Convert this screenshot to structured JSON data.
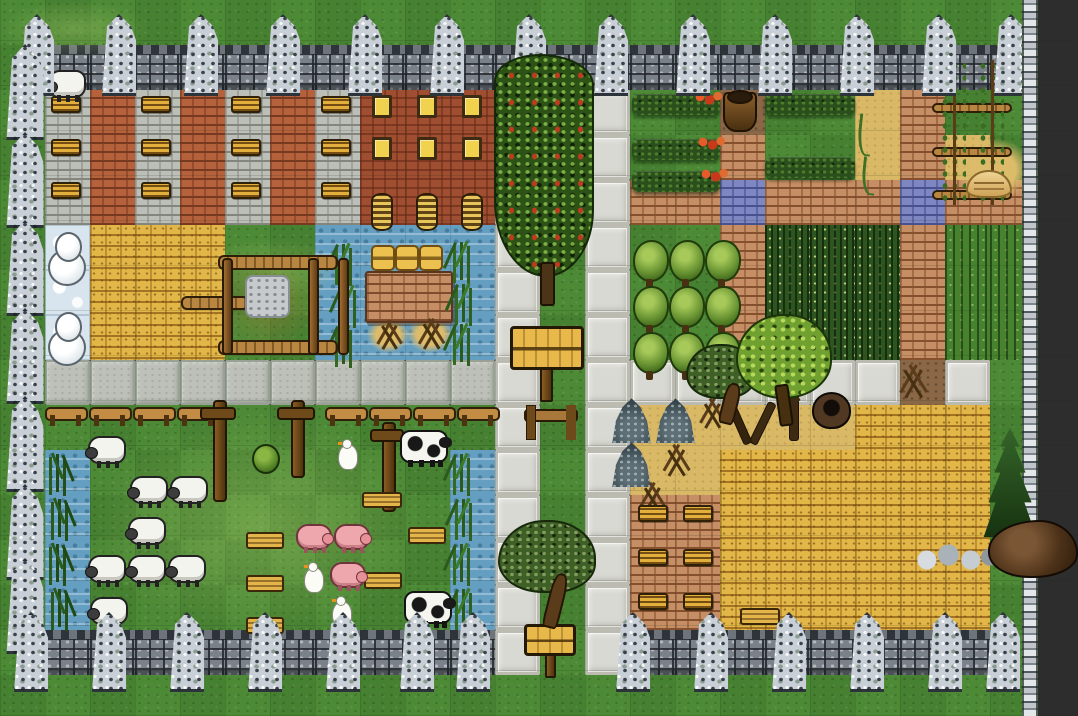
{
  "scene": {
    "description": "top-down tile map of a walled medieval farm village with buildings, orchards, crop fields, pastures with livestock, stone paths and a large hay field",
    "width_px": 1078,
    "height_px": 716,
    "outside_color": "#2d2d2d"
  },
  "palette": {
    "grass": "#4d8a36",
    "path_white": "#d9d9d3",
    "road_gray": "#bcc0b8",
    "water": "#649fc2",
    "ice": "#d8e5ee",
    "hay": "#e3b648",
    "sand": "#d9b866",
    "dirt": "#8a6847",
    "brick_wall": "#c68e64",
    "water_gate_brick": "#7e87c2",
    "gray_building": "#bcbeb8",
    "red_building_stripe": "#b5613c",
    "red_building": "#a04e31",
    "wheat_crop": "#2d5520",
    "spiky_crop": "#47822f",
    "stone_wall": "#7b8189",
    "tower_stone": "#c9cfd6"
  },
  "map": {
    "tile_px": 45,
    "cols": 24,
    "rows_count": 16,
    "legend": {
      "G": "grass",
      "D": "outside",
      "M": "stone-wall",
      "P": "white-path",
      "Q": "gray-road",
      "W": "water",
      "I": "ice",
      "H": "hay",
      "S": "sand",
      "T": "dirt",
      "B": "brick-wall",
      "U": "water-gate",
      "X": "gray-brick-building",
      "R": "red-brick-building",
      "V": "red-building",
      "E": "wheat-crop",
      "F": "spiky-crop"
    },
    "rows": [
      "GGGGGGGGGGGGGGGGGGGGGGGD",
      "GMMMMMMMMMMMMMMMMMMMMMMD",
      "GXRXRXRXVVVPGPGGTGGSBGGD",
      "GXRXRXRXVVVPGPGGBGGSBSGD",
      "GXRXRXRXVVVPGPBBUBBBUBBD",
      "GIHHHGGWWWWPGPGGBEEEBFFD",
      "GIHHHGGWWWWPGPGGBEEEBFFD",
      "GIHHHGGWWWWPGPGGBEEEBFFD",
      "GQQQQQQQQQQPGPPPPPPPTPGD",
      "GGGGGGGGGGGPGPSSSSSHHHGD",
      "GWGGGGGGGGWPGPSSHHHHHHGD",
      "GWGGGGGGGGWPGPBBHHHHHHGD",
      "GWGGGGGGGGWPGPBBHHHHHHGD",
      "GWGGGGGGGGWPGPBBHHHHHHGD",
      "GMMMMMMMMMMPGPMMMMMMMMGD",
      "GGGGGGGGGGGGGGGGGGGGGGGD"
    ]
  },
  "overlays": [
    {
      "t": "lightgrass",
      "x": 0,
      "y": 0,
      "w": 150,
      "h": 58
    },
    {
      "t": "lightgrass",
      "x": 95,
      "y": 412,
      "w": 330,
      "h": 225
    },
    {
      "t": "lightgrass",
      "x": 200,
      "y": 238,
      "w": 145,
      "h": 62
    },
    {
      "t": "drypatch",
      "x": 208,
      "y": 250,
      "w": 120,
      "h": 108
    },
    {
      "t": "sandpatch",
      "x": 367,
      "y": 317,
      "w": 42,
      "h": 36
    },
    {
      "t": "sandpatch",
      "x": 407,
      "y": 316,
      "w": 46,
      "h": 37
    },
    {
      "t": "sandpatch",
      "x": 956,
      "y": 138,
      "w": 76,
      "h": 64
    },
    {
      "t": "window-log",
      "x": 51,
      "y": 96,
      "w": 30,
      "h": 17
    },
    {
      "t": "window-log",
      "x": 141,
      "y": 96,
      "w": 30,
      "h": 17
    },
    {
      "t": "window-log",
      "x": 231,
      "y": 96,
      "w": 30,
      "h": 17
    },
    {
      "t": "window-log",
      "x": 321,
      "y": 96,
      "w": 30,
      "h": 17
    },
    {
      "t": "window-log",
      "x": 51,
      "y": 139,
      "w": 30,
      "h": 17
    },
    {
      "t": "window-log",
      "x": 141,
      "y": 139,
      "w": 30,
      "h": 17
    },
    {
      "t": "window-log",
      "x": 231,
      "y": 139,
      "w": 30,
      "h": 17
    },
    {
      "t": "window-log",
      "x": 321,
      "y": 139,
      "w": 30,
      "h": 17
    },
    {
      "t": "window-log",
      "x": 51,
      "y": 182,
      "w": 30,
      "h": 17
    },
    {
      "t": "window-log",
      "x": 141,
      "y": 182,
      "w": 30,
      "h": 17
    },
    {
      "t": "window-log",
      "x": 231,
      "y": 182,
      "w": 30,
      "h": 17
    },
    {
      "t": "window-log",
      "x": 321,
      "y": 182,
      "w": 30,
      "h": 17
    },
    {
      "t": "window-yellow",
      "x": 372,
      "y": 95,
      "w": 20,
      "h": 23
    },
    {
      "t": "window-yellow",
      "x": 417,
      "y": 95,
      "w": 20,
      "h": 23
    },
    {
      "t": "window-yellow",
      "x": 462,
      "y": 95,
      "w": 20,
      "h": 23
    },
    {
      "t": "window-yellow",
      "x": 372,
      "y": 137,
      "w": 20,
      "h": 23
    },
    {
      "t": "window-yellow",
      "x": 417,
      "y": 137,
      "w": 20,
      "h": 23
    },
    {
      "t": "window-yellow",
      "x": 462,
      "y": 137,
      "w": 20,
      "h": 23
    },
    {
      "t": "coil",
      "x": 371,
      "y": 193,
      "w": 22,
      "h": 38
    },
    {
      "t": "coil",
      "x": 416,
      "y": 193,
      "w": 22,
      "h": 38
    },
    {
      "t": "coil",
      "x": 461,
      "y": 193,
      "w": 22,
      "h": 38
    },
    {
      "t": "hedge",
      "x": 632,
      "y": 94,
      "w": 88,
      "h": 21
    },
    {
      "t": "hedge",
      "x": 632,
      "y": 139,
      "w": 88,
      "h": 21
    },
    {
      "t": "hedge",
      "x": 632,
      "y": 171,
      "w": 88,
      "h": 21
    },
    {
      "t": "hedge",
      "x": 765,
      "y": 94,
      "w": 90,
      "h": 21
    },
    {
      "t": "hedge",
      "x": 765,
      "y": 157,
      "w": 90,
      "h": 21
    },
    {
      "t": "fruit",
      "x": 692,
      "y": 89,
      "w": 32,
      "h": 18
    },
    {
      "t": "fruit",
      "x": 695,
      "y": 134,
      "w": 32,
      "h": 18
    },
    {
      "t": "fruit",
      "x": 698,
      "y": 166,
      "w": 32,
      "h": 18
    },
    {
      "t": "sprout",
      "x": 858,
      "y": 114,
      "w": 14,
      "h": 42
    },
    {
      "t": "sprout",
      "x": 862,
      "y": 157,
      "w": 14,
      "h": 38
    },
    {
      "t": "pot",
      "x": 723,
      "y": 92,
      "w": 34,
      "h": 40
    },
    {
      "t": "fence-bar",
      "x": 932,
      "y": 103,
      "w": 80,
      "h": 10
    },
    {
      "t": "fence-bar",
      "x": 932,
      "y": 147,
      "w": 80,
      "h": 10
    },
    {
      "t": "fence-bar",
      "x": 932,
      "y": 190,
      "w": 80,
      "h": 10
    },
    {
      "t": "beanpole",
      "x": 940,
      "y": 60,
      "w": 26,
      "h": 145
    },
    {
      "t": "beanpole",
      "x": 978,
      "y": 60,
      "w": 26,
      "h": 145
    },
    {
      "t": "bread",
      "x": 966,
      "y": 170,
      "w": 46,
      "h": 28
    },
    {
      "t": "shrub",
      "x": 633,
      "y": 240,
      "w": 36,
      "h": 42
    },
    {
      "t": "shrub",
      "x": 669,
      "y": 240,
      "w": 36,
      "h": 42
    },
    {
      "t": "shrub",
      "x": 705,
      "y": 240,
      "w": 36,
      "h": 42
    },
    {
      "t": "shrub",
      "x": 633,
      "y": 286,
      "w": 36,
      "h": 42
    },
    {
      "t": "shrub",
      "x": 669,
      "y": 286,
      "w": 36,
      "h": 42
    },
    {
      "t": "shrub",
      "x": 705,
      "y": 286,
      "w": 36,
      "h": 42
    },
    {
      "t": "shrub",
      "x": 633,
      "y": 332,
      "w": 36,
      "h": 42
    },
    {
      "t": "shrub",
      "x": 669,
      "y": 332,
      "w": 36,
      "h": 42
    },
    {
      "t": "shrub",
      "x": 705,
      "y": 332,
      "w": 36,
      "h": 42
    },
    {
      "t": "brickchunk",
      "x": 365,
      "y": 271,
      "w": 88,
      "h": 52
    },
    {
      "t": "bale",
      "x": 371,
      "y": 245,
      "w": 24,
      "h": 26
    },
    {
      "t": "bale",
      "x": 395,
      "y": 245,
      "w": 24,
      "h": 26
    },
    {
      "t": "bale",
      "x": 419,
      "y": 245,
      "w": 24,
      "h": 26
    },
    {
      "t": "deadbush",
      "x": 372,
      "y": 321,
      "w": 32,
      "h": 30
    },
    {
      "t": "deadbush",
      "x": 412,
      "y": 319,
      "w": 36,
      "h": 32
    },
    {
      "t": "corn",
      "x": 330,
      "y": 242,
      "w": 26,
      "h": 40
    },
    {
      "t": "corn",
      "x": 334,
      "y": 284,
      "w": 26,
      "h": 40
    },
    {
      "t": "corn",
      "x": 330,
      "y": 324,
      "w": 26,
      "h": 40
    },
    {
      "t": "corn",
      "x": 448,
      "y": 240,
      "w": 26,
      "h": 40
    },
    {
      "t": "corn",
      "x": 450,
      "y": 282,
      "w": 26,
      "h": 40
    },
    {
      "t": "corn",
      "x": 448,
      "y": 322,
      "w": 26,
      "h": 40
    },
    {
      "t": "corn",
      "x": 448,
      "y": 452,
      "w": 26,
      "h": 40
    },
    {
      "t": "corn",
      "x": 450,
      "y": 497,
      "w": 26,
      "h": 40
    },
    {
      "t": "corn",
      "x": 448,
      "y": 542,
      "w": 26,
      "h": 40
    },
    {
      "t": "corn",
      "x": 450,
      "y": 587,
      "w": 26,
      "h": 40
    },
    {
      "t": "reed",
      "x": 44,
      "y": 452,
      "w": 26,
      "h": 40
    },
    {
      "t": "reed",
      "x": 46,
      "y": 497,
      "w": 26,
      "h": 40
    },
    {
      "t": "reed",
      "x": 44,
      "y": 542,
      "w": 26,
      "h": 40
    },
    {
      "t": "reed",
      "x": 46,
      "y": 587,
      "w": 26,
      "h": 40
    },
    {
      "t": "fence-bar",
      "x": 218,
      "y": 255,
      "w": 120,
      "h": 15
    },
    {
      "t": "fence-bar",
      "x": 218,
      "y": 340,
      "w": 120,
      "h": 15
    },
    {
      "t": "fence-bar",
      "x": 181,
      "y": 296,
      "w": 68,
      "h": 14
    },
    {
      "t": "fence-pole",
      "x": 222,
      "y": 258,
      "w": 11,
      "h": 97
    },
    {
      "t": "fence-pole",
      "x": 308,
      "y": 258,
      "w": 11,
      "h": 97
    },
    {
      "t": "fence-pole",
      "x": 338,
      "y": 258,
      "w": 11,
      "h": 97
    },
    {
      "t": "stonepatch",
      "x": 245,
      "y": 275,
      "w": 45,
      "h": 43
    },
    {
      "t": "rail",
      "x": 45,
      "y": 407,
      "w": 43,
      "h": 21
    },
    {
      "t": "rail",
      "x": 89,
      "y": 407,
      "w": 43,
      "h": 21
    },
    {
      "t": "rail",
      "x": 133,
      "y": 407,
      "w": 43,
      "h": 21
    },
    {
      "t": "rail",
      "x": 177,
      "y": 407,
      "w": 43,
      "h": 21
    },
    {
      "t": "rail",
      "x": 325,
      "y": 407,
      "w": 43,
      "h": 21
    },
    {
      "t": "rail",
      "x": 369,
      "y": 407,
      "w": 43,
      "h": 21
    },
    {
      "t": "rail",
      "x": 413,
      "y": 407,
      "w": 43,
      "h": 21
    },
    {
      "t": "rail",
      "x": 457,
      "y": 407,
      "w": 43,
      "h": 21
    },
    {
      "t": "tallpost",
      "x": 204,
      "y": 400,
      "w": 28,
      "h": 102
    },
    {
      "t": "tallpost",
      "x": 281,
      "y": 400,
      "w": 30,
      "h": 78
    },
    {
      "t": "tallpost",
      "x": 374,
      "y": 422,
      "w": 26,
      "h": 90
    },
    {
      "t": "plank",
      "x": 362,
      "y": 492,
      "w": 40,
      "h": 16
    },
    {
      "t": "plank",
      "x": 246,
      "y": 532,
      "w": 38,
      "h": 17
    },
    {
      "t": "plank",
      "x": 246,
      "y": 575,
      "w": 38,
      "h": 17
    },
    {
      "t": "plank",
      "x": 246,
      "y": 617,
      "w": 38,
      "h": 17
    },
    {
      "t": "plank",
      "x": 408,
      "y": 527,
      "w": 38,
      "h": 17
    },
    {
      "t": "plank",
      "x": 364,
      "y": 572,
      "w": 38,
      "h": 17
    },
    {
      "t": "plank",
      "x": 740,
      "y": 608,
      "w": 40,
      "h": 17
    },
    {
      "t": "gate",
      "x": 524,
      "y": 405,
      "w": 54,
      "h": 33
    },
    {
      "t": "bush",
      "x": 252,
      "y": 444,
      "w": 28,
      "h": 30
    },
    {
      "t": "rockpile",
      "x": 611,
      "y": 397,
      "w": 41,
      "h": 46
    },
    {
      "t": "rockpile",
      "x": 655,
      "y": 397,
      "w": 41,
      "h": 46
    },
    {
      "t": "rockpile",
      "x": 611,
      "y": 441,
      "w": 41,
      "h": 46
    },
    {
      "t": "deadbush",
      "x": 694,
      "y": 399,
      "w": 33,
      "h": 31
    },
    {
      "t": "deadbush",
      "x": 657,
      "y": 445,
      "w": 35,
      "h": 33
    },
    {
      "t": "deadbush",
      "x": 633,
      "y": 483,
      "w": 35,
      "h": 31
    },
    {
      "t": "deadbush",
      "x": 894,
      "y": 364,
      "w": 36,
      "h": 36
    },
    {
      "t": "dead-tree",
      "x": 724,
      "y": 392,
      "w": 48,
      "h": 52
    },
    {
      "t": "trunk",
      "x": 773,
      "y": 393,
      "w": 36,
      "h": 48
    },
    {
      "t": "well",
      "x": 812,
      "y": 392,
      "w": 39,
      "h": 37
    },
    {
      "t": "window-log",
      "x": 638,
      "y": 505,
      "w": 30,
      "h": 17
    },
    {
      "t": "window-log",
      "x": 683,
      "y": 505,
      "w": 30,
      "h": 17
    },
    {
      "t": "window-log",
      "x": 638,
      "y": 549,
      "w": 30,
      "h": 17
    },
    {
      "t": "window-log",
      "x": 683,
      "y": 549,
      "w": 30,
      "h": 17
    },
    {
      "t": "window-log",
      "x": 638,
      "y": 593,
      "w": 30,
      "h": 17
    },
    {
      "t": "window-log",
      "x": 683,
      "y": 593,
      "w": 30,
      "h": 17
    },
    {
      "t": "sign",
      "x": 510,
      "y": 326,
      "w": 74,
      "h": 44
    },
    {
      "t": "signpost",
      "x": 540,
      "y": 368,
      "w": 13,
      "h": 34
    },
    {
      "t": "sign",
      "x": 524,
      "y": 624,
      "w": 52,
      "h": 32
    },
    {
      "t": "signpost",
      "x": 545,
      "y": 654,
      "w": 11,
      "h": 24
    },
    {
      "t": "snowman",
      "x": 48,
      "y": 232,
      "w": 38,
      "h": 54
    },
    {
      "t": "snowman",
      "x": 48,
      "y": 312,
      "w": 38,
      "h": 54
    },
    {
      "t": "sheep",
      "x": 48,
      "y": 70,
      "w": 38,
      "h": 28
    },
    {
      "t": "sheep",
      "x": 88,
      "y": 436,
      "w": 38,
      "h": 28
    },
    {
      "t": "sheep",
      "x": 130,
      "y": 476,
      "w": 38,
      "h": 28
    },
    {
      "t": "sheep",
      "x": 170,
      "y": 476,
      "w": 38,
      "h": 28
    },
    {
      "t": "sheep",
      "x": 128,
      "y": 517,
      "w": 38,
      "h": 28
    },
    {
      "t": "sheep",
      "x": 88,
      "y": 555,
      "w": 38,
      "h": 28
    },
    {
      "t": "sheep",
      "x": 128,
      "y": 555,
      "w": 38,
      "h": 28
    },
    {
      "t": "sheep",
      "x": 168,
      "y": 555,
      "w": 38,
      "h": 28
    },
    {
      "t": "sheep",
      "x": 90,
      "y": 597,
      "w": 38,
      "h": 28
    },
    {
      "t": "pig",
      "x": 296,
      "y": 524,
      "w": 36,
      "h": 26
    },
    {
      "t": "pig",
      "x": 334,
      "y": 524,
      "w": 36,
      "h": 26
    },
    {
      "t": "pig",
      "x": 330,
      "y": 562,
      "w": 36,
      "h": 26
    },
    {
      "t": "cow",
      "x": 400,
      "y": 430,
      "w": 48,
      "h": 33
    },
    {
      "t": "cow",
      "x": 404,
      "y": 591,
      "w": 48,
      "h": 33
    },
    {
      "t": "goose",
      "x": 338,
      "y": 444,
      "w": 20,
      "h": 26
    },
    {
      "t": "goose",
      "x": 304,
      "y": 567,
      "w": 20,
      "h": 26
    },
    {
      "t": "goose",
      "x": 332,
      "y": 601,
      "w": 20,
      "h": 26
    },
    {
      "t": "tower",
      "x": 14,
      "y": 14,
      "w": 46,
      "h": 82
    },
    {
      "t": "tower",
      "x": 96,
      "y": 14,
      "w": 46,
      "h": 82
    },
    {
      "t": "tower",
      "x": 178,
      "y": 14,
      "w": 46,
      "h": 82
    },
    {
      "t": "tower",
      "x": 260,
      "y": 14,
      "w": 46,
      "h": 82
    },
    {
      "t": "tower",
      "x": 342,
      "y": 14,
      "w": 46,
      "h": 82
    },
    {
      "t": "tower",
      "x": 424,
      "y": 14,
      "w": 46,
      "h": 82
    },
    {
      "t": "tower",
      "x": 506,
      "y": 14,
      "w": 46,
      "h": 82
    },
    {
      "t": "tower",
      "x": 588,
      "y": 14,
      "w": 46,
      "h": 82
    },
    {
      "t": "tower",
      "x": 670,
      "y": 14,
      "w": 46,
      "h": 82
    },
    {
      "t": "tower",
      "x": 752,
      "y": 14,
      "w": 46,
      "h": 82
    },
    {
      "t": "tower",
      "x": 834,
      "y": 14,
      "w": 46,
      "h": 82
    },
    {
      "t": "tower",
      "x": 916,
      "y": 14,
      "w": 46,
      "h": 82
    },
    {
      "t": "tower",
      "x": 988,
      "y": 14,
      "w": 46,
      "h": 82
    },
    {
      "t": "tower",
      "x": 0,
      "y": 44,
      "w": 50,
      "h": 96
    },
    {
      "t": "tower",
      "x": 0,
      "y": 132,
      "w": 50,
      "h": 96
    },
    {
      "t": "tower",
      "x": 0,
      "y": 220,
      "w": 50,
      "h": 96
    },
    {
      "t": "tower",
      "x": 0,
      "y": 308,
      "w": 50,
      "h": 96
    },
    {
      "t": "tower",
      "x": 0,
      "y": 396,
      "w": 50,
      "h": 96
    },
    {
      "t": "tower",
      "x": 0,
      "y": 484,
      "w": 50,
      "h": 96
    },
    {
      "t": "tower",
      "x": 0,
      "y": 558,
      "w": 50,
      "h": 96
    },
    {
      "t": "tower",
      "x": 8,
      "y": 612,
      "w": 46,
      "h": 80
    },
    {
      "t": "tower",
      "x": 86,
      "y": 612,
      "w": 46,
      "h": 80
    },
    {
      "t": "tower",
      "x": 164,
      "y": 612,
      "w": 46,
      "h": 80
    },
    {
      "t": "tower",
      "x": 242,
      "y": 612,
      "w": 46,
      "h": 80
    },
    {
      "t": "tower",
      "x": 320,
      "y": 612,
      "w": 46,
      "h": 80
    },
    {
      "t": "tower",
      "x": 394,
      "y": 612,
      "w": 46,
      "h": 80
    },
    {
      "t": "tower",
      "x": 450,
      "y": 612,
      "w": 46,
      "h": 80
    },
    {
      "t": "tower",
      "x": 610,
      "y": 612,
      "w": 46,
      "h": 80
    },
    {
      "t": "tower",
      "x": 688,
      "y": 612,
      "w": 46,
      "h": 80
    },
    {
      "t": "tower",
      "x": 766,
      "y": 612,
      "w": 46,
      "h": 80
    },
    {
      "t": "tower",
      "x": 844,
      "y": 612,
      "w": 46,
      "h": 80
    },
    {
      "t": "tower",
      "x": 922,
      "y": 612,
      "w": 46,
      "h": 80
    },
    {
      "t": "tower",
      "x": 980,
      "y": 612,
      "w": 46,
      "h": 80
    },
    {
      "t": "thinwall",
      "x": 1022,
      "y": 0,
      "w": 16,
      "h": 716
    },
    {
      "t": "apple-tree",
      "x": 494,
      "y": 54,
      "w": 100,
      "h": 252
    },
    {
      "t": "olive-tree",
      "x": 686,
      "y": 344,
      "w": 70,
      "h": 80
    },
    {
      "t": "round-tree",
      "x": 736,
      "y": 314,
      "w": 96,
      "h": 112
    },
    {
      "t": "olive-tree",
      "x": 498,
      "y": 520,
      "w": 98,
      "h": 108
    },
    {
      "t": "pine-tree",
      "x": 980,
      "y": 428,
      "w": 60,
      "h": 124
    },
    {
      "t": "stones",
      "x": 914,
      "y": 534,
      "w": 86,
      "h": 42
    },
    {
      "t": "boar-rock",
      "x": 988,
      "y": 520,
      "w": 90,
      "h": 58
    }
  ]
}
